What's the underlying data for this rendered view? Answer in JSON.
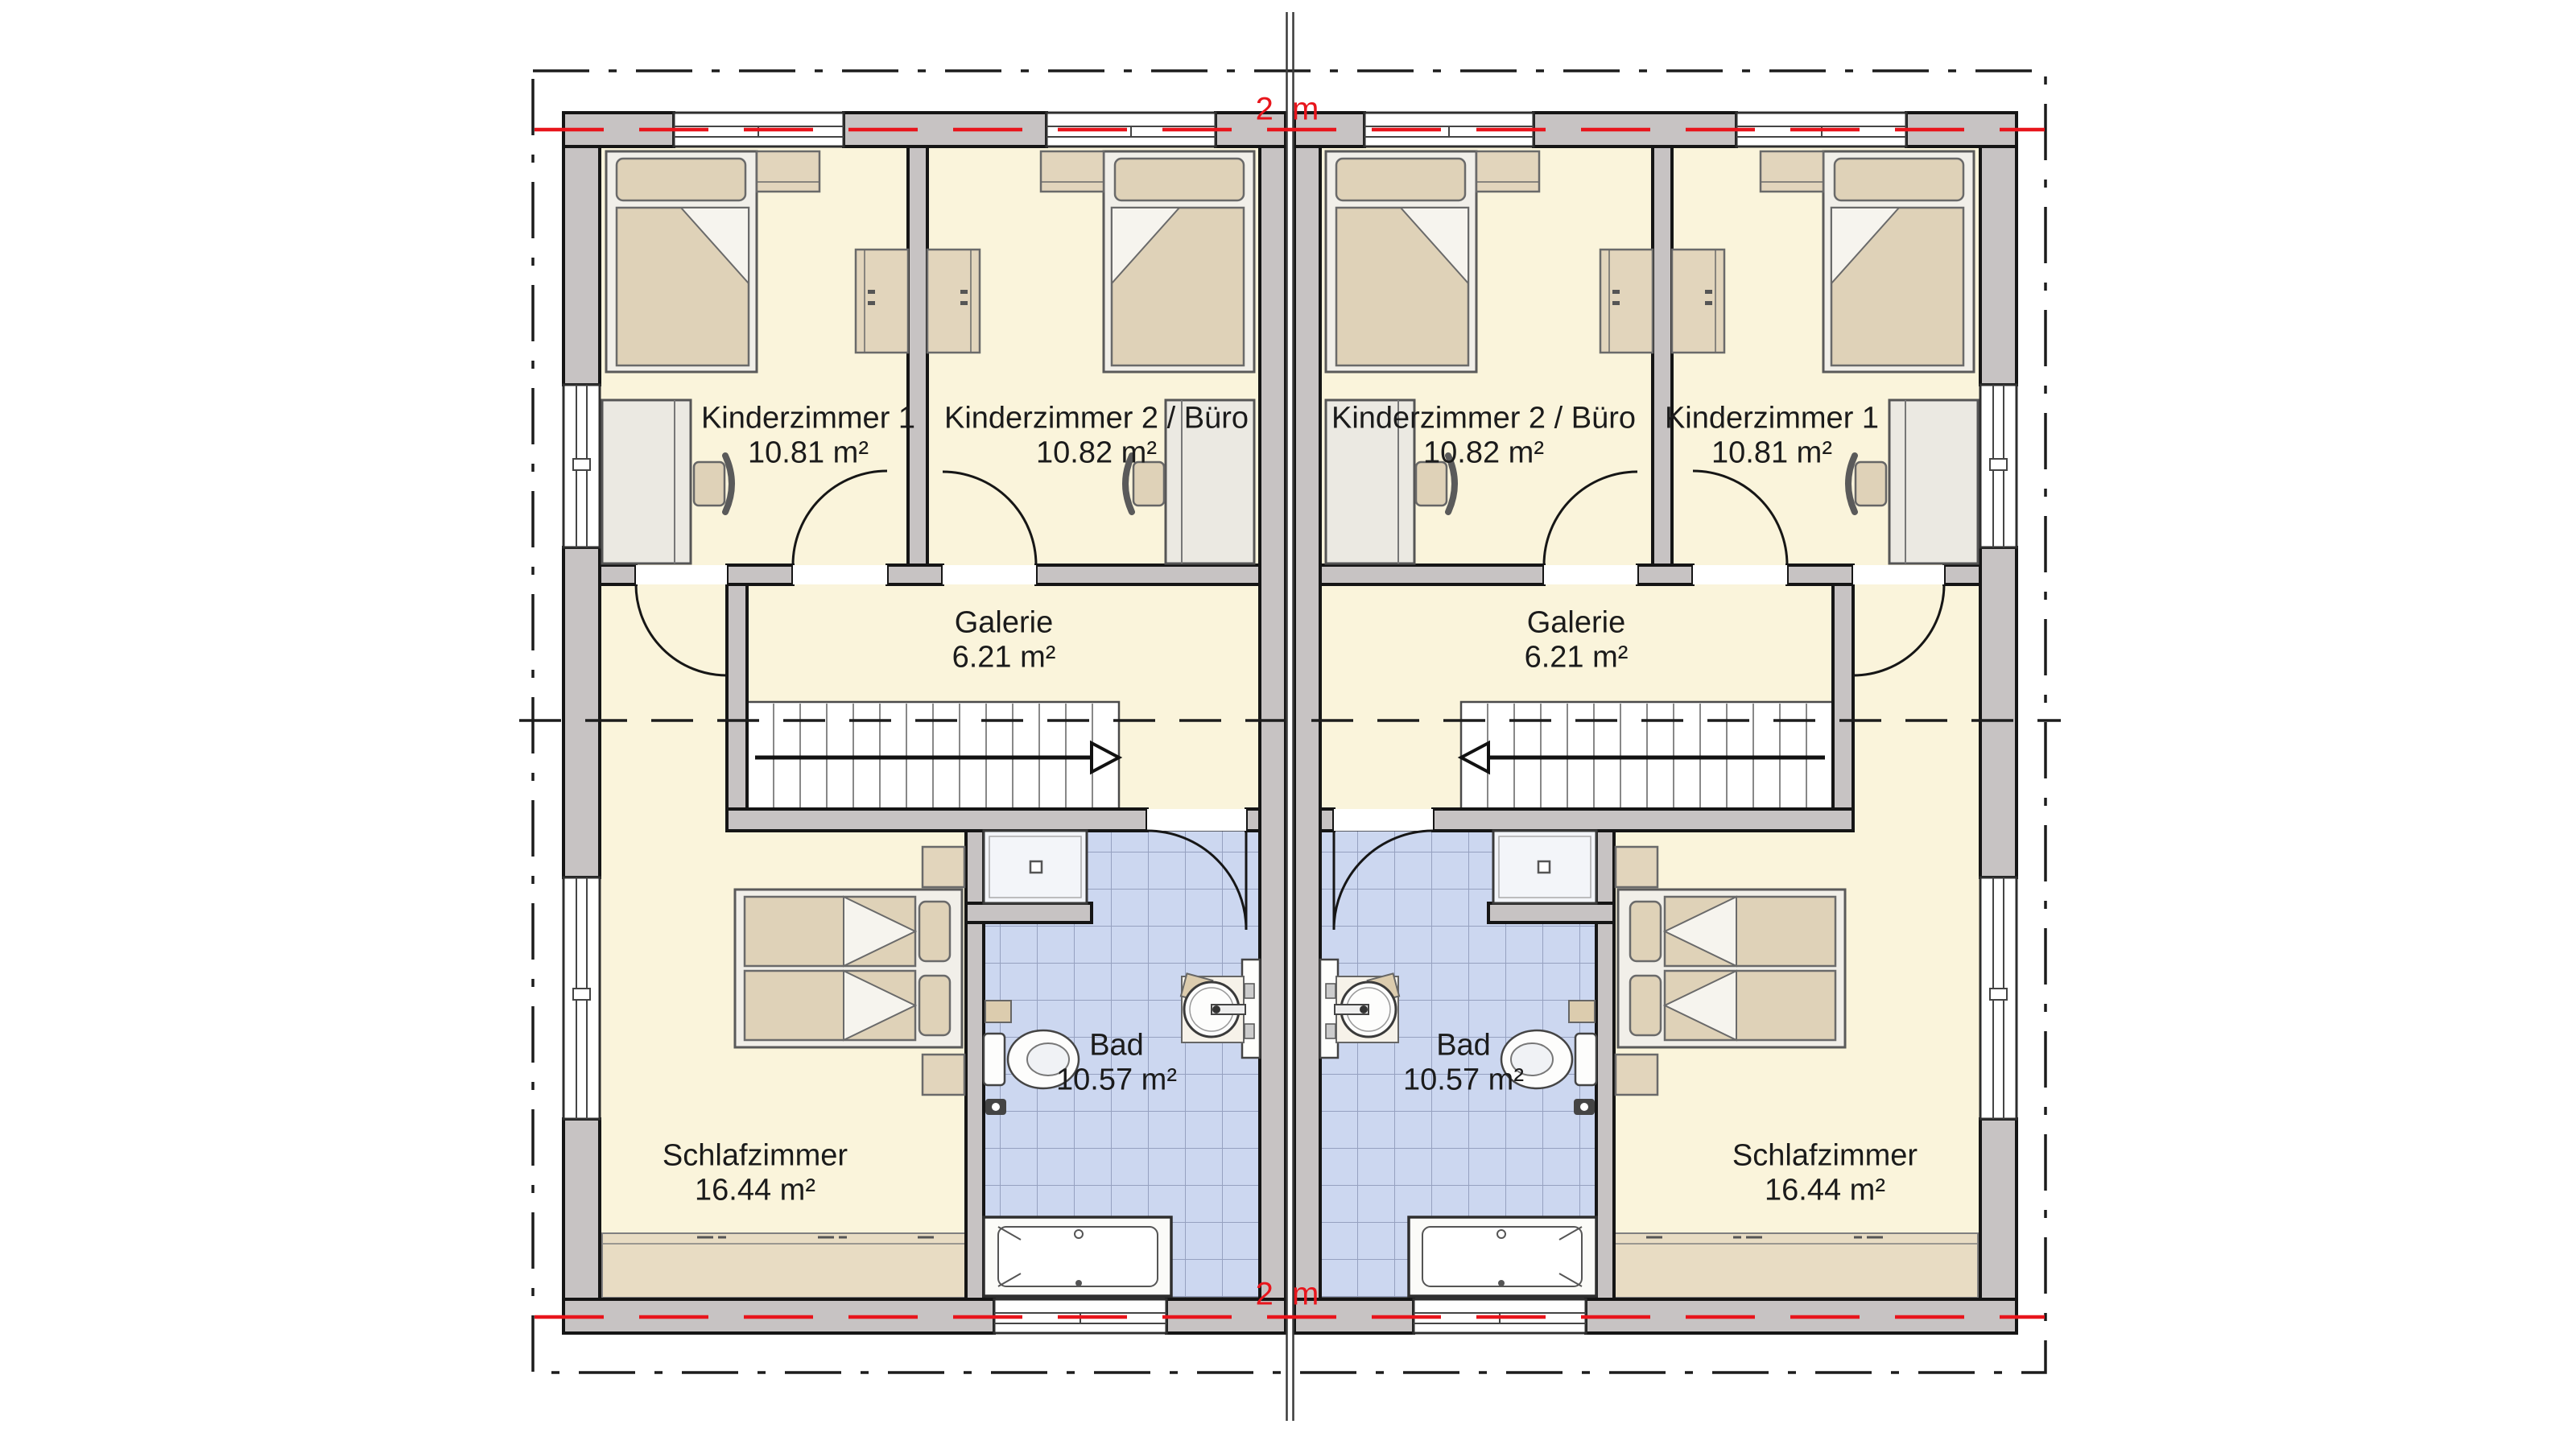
{
  "drawing": {
    "kind": "duplex-upper-floor-plan",
    "dimension_marker_top": "2 m",
    "dimension_marker_bottom": "2 m"
  },
  "units": {
    "left": {
      "rooms": [
        {
          "id": "kinderzimmer1",
          "name": "Kinderzimmer 1",
          "area": "10.81 m²"
        },
        {
          "id": "kinderzimmer2-buero",
          "name": "Kinderzimmer 2 / Büro",
          "area": "10.82 m²"
        },
        {
          "id": "galerie",
          "name": "Galerie",
          "area": "6.21 m²"
        },
        {
          "id": "bad",
          "name": "Bad",
          "area": "10.57 m²"
        },
        {
          "id": "schlafzimmer",
          "name": "Schlafzimmer",
          "area": "16.44 m²"
        }
      ]
    },
    "right": {
      "rooms": [
        {
          "id": "kinderzimmer2-buero",
          "name": "Kinderzimmer 2 / Büro",
          "area": "10.82 m²"
        },
        {
          "id": "kinderzimmer1",
          "name": "Kinderzimmer 1",
          "area": "10.81 m²"
        },
        {
          "id": "galerie",
          "name": "Galerie",
          "area": "6.21 m²"
        },
        {
          "id": "bad",
          "name": "Bad",
          "area": "10.57 m²"
        },
        {
          "id": "schlafzimmer",
          "name": "Schlafzimmer",
          "area": "16.44 m²"
        }
      ]
    }
  },
  "colors": {
    "floor": "#FAF4DB",
    "bath_tile": "#CCD7F0",
    "wall_fill": "#C7C3C3",
    "outline": "#151515",
    "furniture_tan": "#DFD2B8",
    "marker_red": "#E8151C"
  }
}
